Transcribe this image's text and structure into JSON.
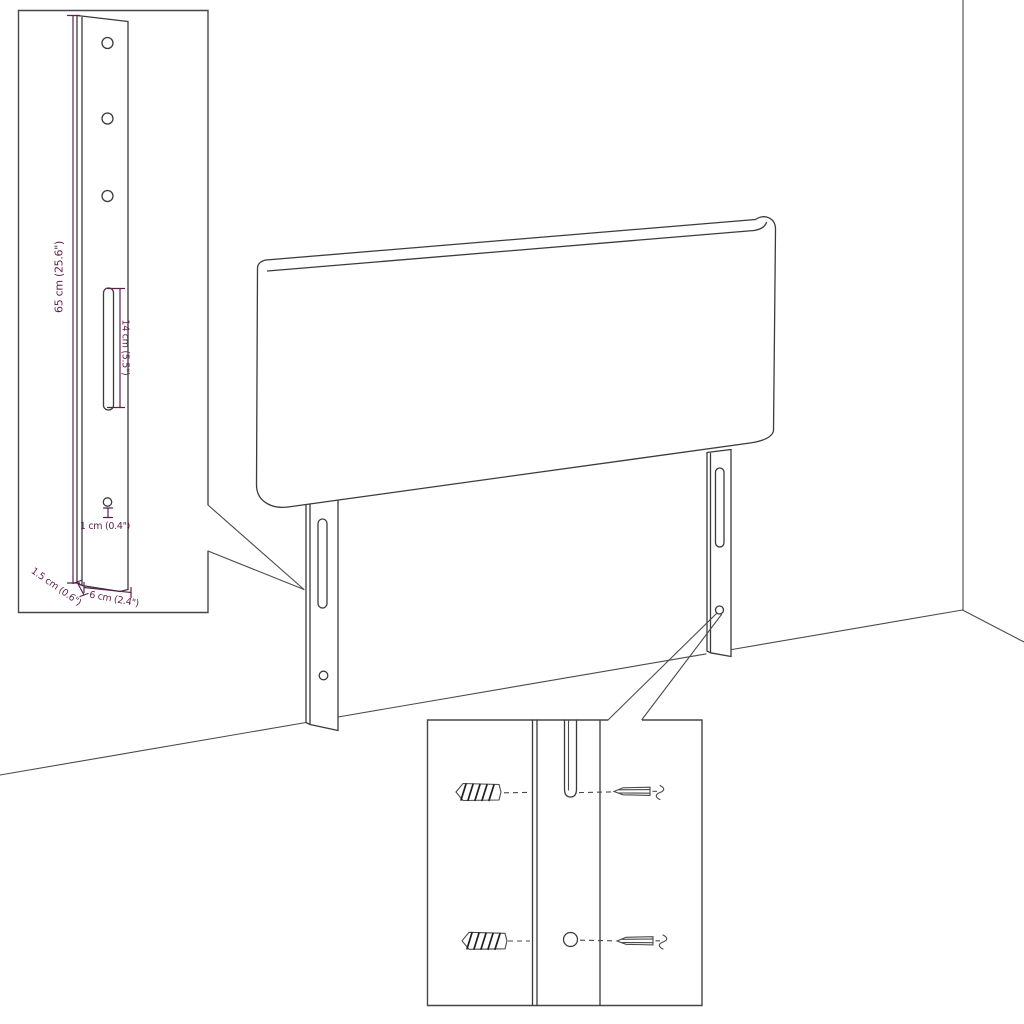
{
  "figure": "headboard wall-mount assembly line diagram",
  "colors": {
    "dimension_accent": "#5E1F4E",
    "line_color": "#3B3B3B",
    "background": "#FFFFFF"
  },
  "dimensions": {
    "leg_height": "65 cm (25.6\")",
    "slot_length": "14 cm (5.5\")",
    "hole_diameter": "1 cm (0.4\")",
    "leg_thickness": "1.5 cm (0.6\")",
    "leg_width": "6 cm (2.4\")"
  }
}
